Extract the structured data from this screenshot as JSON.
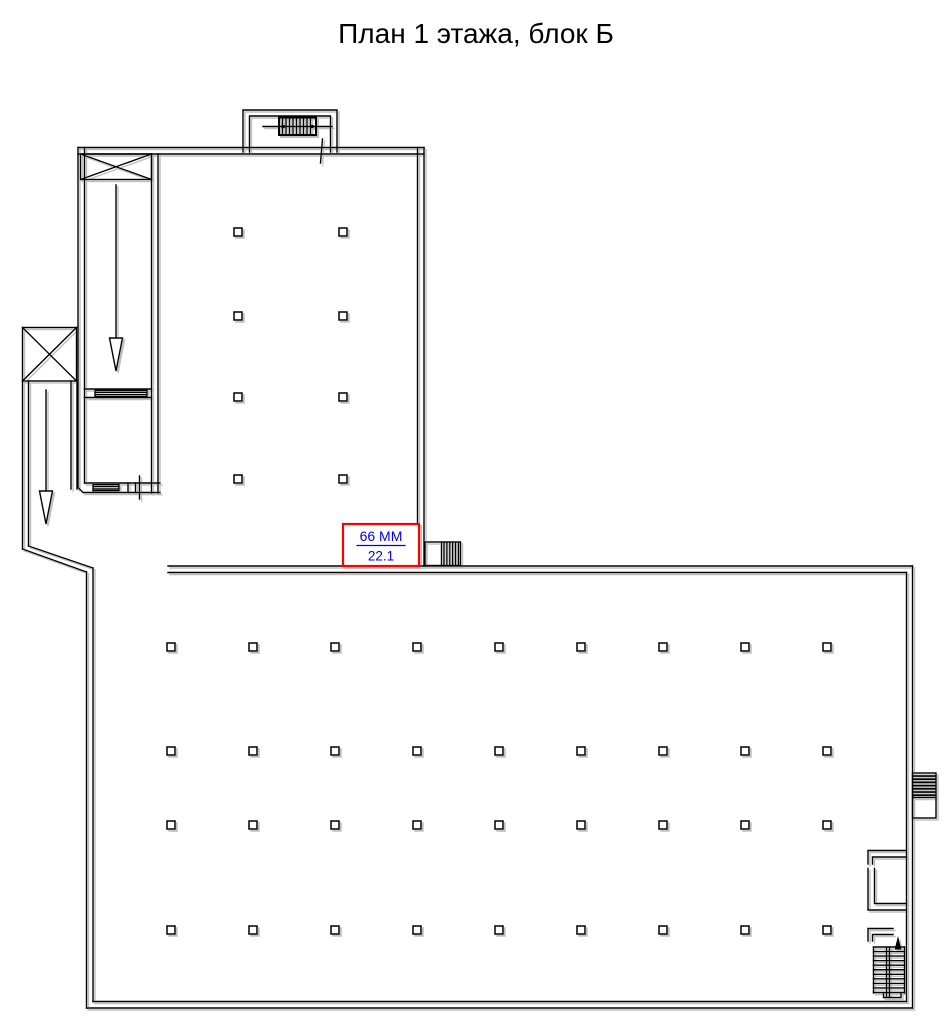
{
  "page": {
    "title": "План 1 этажа, блок Б"
  },
  "room_label": {
    "line1": "66 ММ",
    "line2": "22.1",
    "text_color": "#0000ee",
    "box_color": "#ff0000"
  },
  "plan": {
    "line_color": "#000000",
    "shadow_color": "#b4b4b4",
    "background": "#ffffff",
    "upper_hall_grid": {
      "cols": 2,
      "rows": 4
    },
    "lower_hall_grid": {
      "cols": 9,
      "rows": 4
    },
    "icons": {
      "elevator_shaft": "crossed-box",
      "direction_arrow": "open-arrow-down",
      "top_stairs": "hatched-treads",
      "bottom_right_stairs": "hatched-treads",
      "stairs_up_arrow": "filled-arrow-up",
      "entrance_steps": "vertical-hatch-block",
      "side_dock": "horizontal-hatch-block"
    }
  }
}
